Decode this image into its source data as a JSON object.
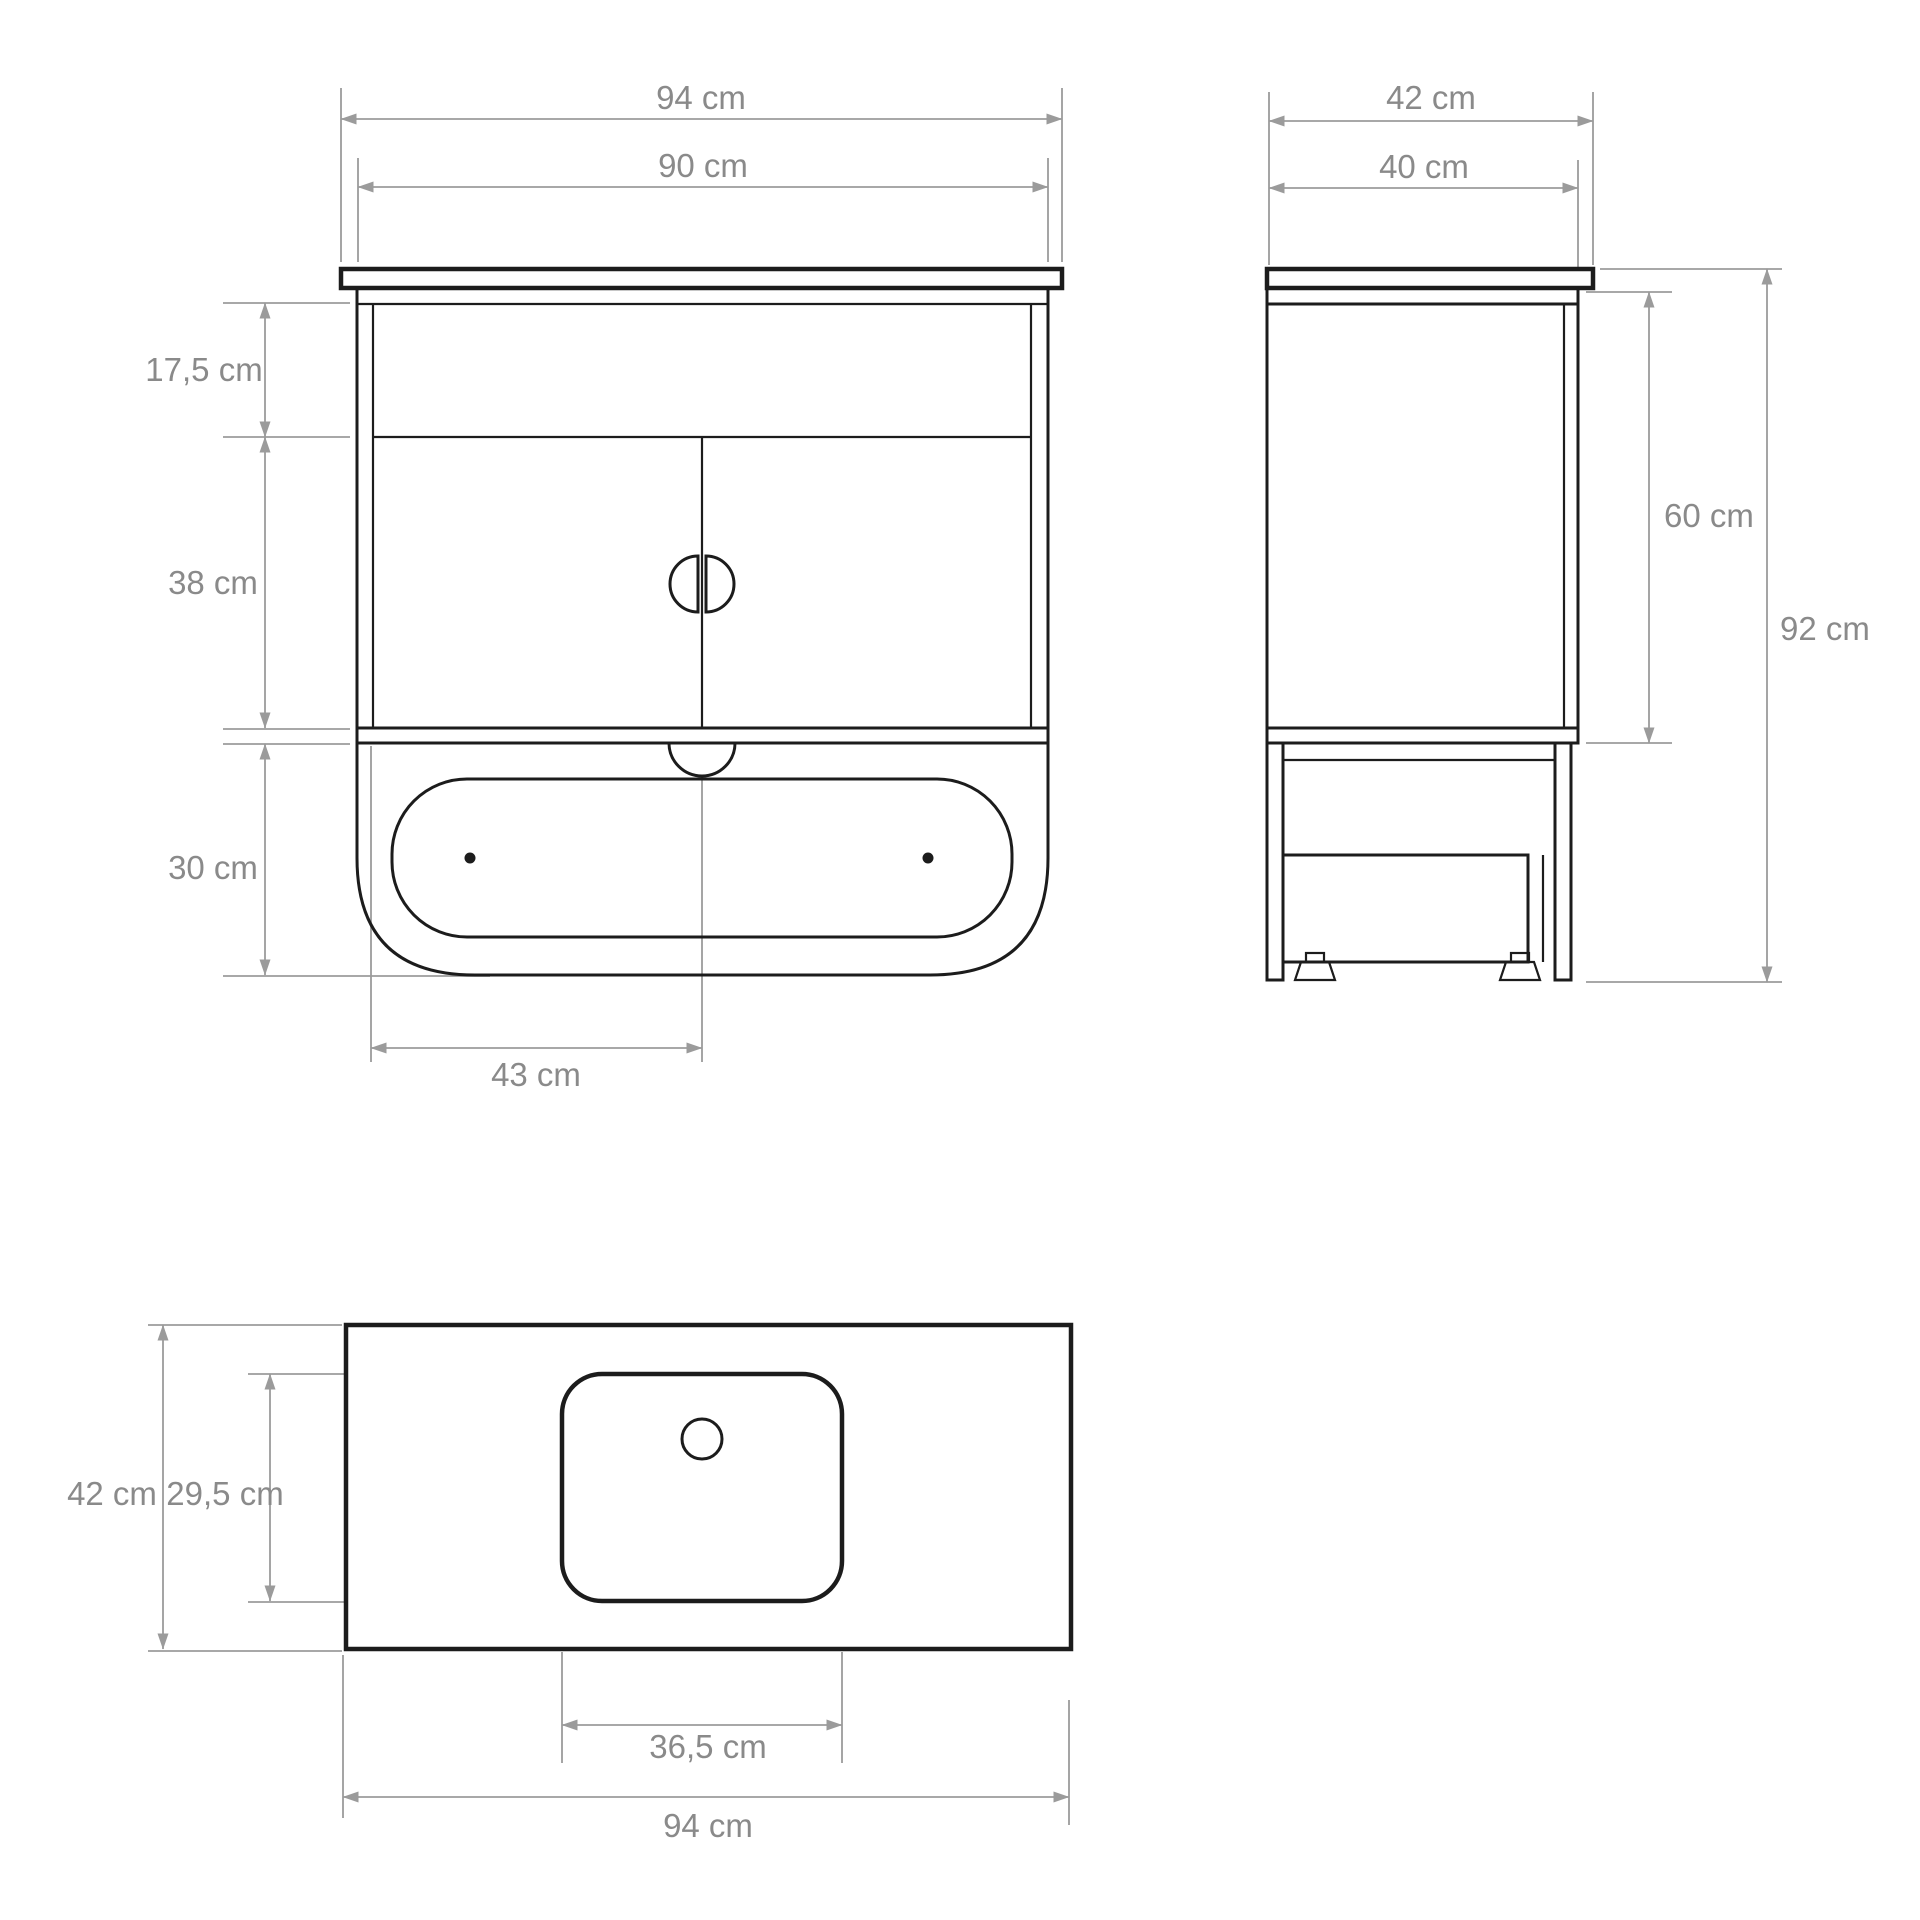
{
  "drawing": {
    "type": "furniture-technical-drawing",
    "subject": "bathroom vanity cabinet with countertop, two doors and bottom drawer",
    "unit": "cm",
    "colors": {
      "outline": "#1c1c1c",
      "dimension_lines": "#9b9b9b",
      "label_text": "#8a8a8a",
      "background": "#ffffff"
    }
  },
  "labels": {
    "front": {
      "outer_width": "94 cm",
      "inner_width": "90 cm",
      "top_height": "17,5 cm",
      "middle_height": "38 cm",
      "bottom_height": "30 cm",
      "center_offset": "43 cm"
    },
    "side": {
      "outer_depth": "42 cm",
      "inner_depth": "40 cm",
      "cabinet_height": "60 cm",
      "total_height": "92 cm"
    },
    "top": {
      "depth": "42 cm",
      "basin_depth": "29,5 cm",
      "basin_width": "36,5 cm",
      "width": "94 cm"
    }
  }
}
